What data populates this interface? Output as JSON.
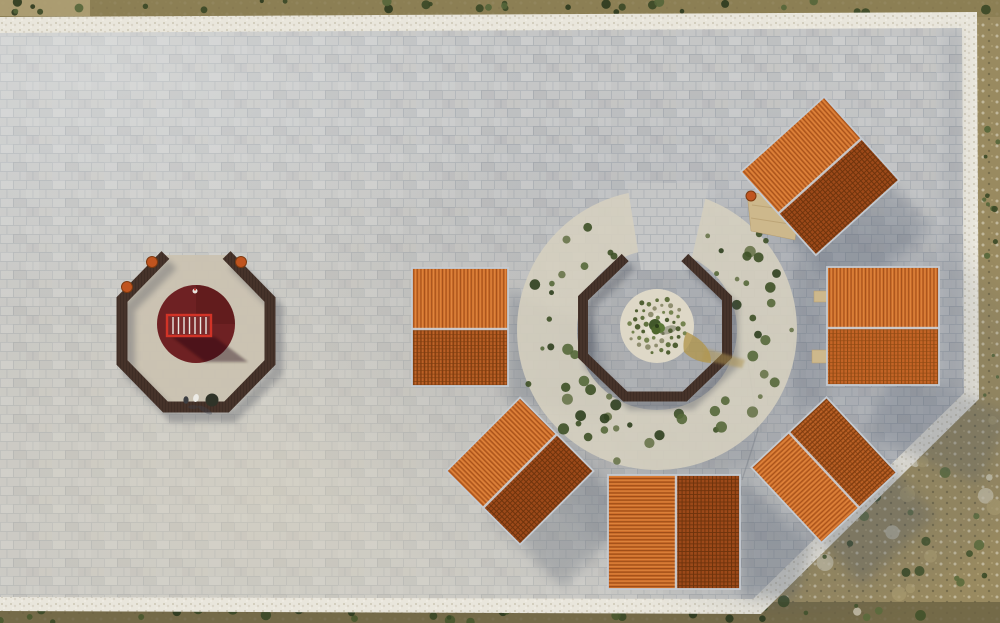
{
  "meta": {
    "title": "Aerial drone view of a stone-paved plaza with six orange-tiled pavilions around an octagonal planting circle and an octagonal play enclosure",
    "type": "aerial-photograph",
    "width": 1000,
    "height": 623
  },
  "palette": {
    "pavement": "#c3c4c5",
    "pavement_dark": "#aab0b6",
    "white_border": "#e9e6dc",
    "terrain": "#998a60",
    "terrain_top": "#8a7c52",
    "terrain_bottom": "#6d6444",
    "bush_green": "#3f5026",
    "roof_light": "#cf6f2c",
    "roof_dark": "#9c4919",
    "ridge_trim": "#cdd2d8",
    "bench_wood": "#46332a",
    "play_circle": "#6e2123",
    "railing_red": "#d23327",
    "gravel": "#d6d0bf",
    "gravel_light": "#ded8c7",
    "dirt": "#b2974f",
    "tree_green": "#4e662c",
    "barrel_orange": "#c0541f",
    "wood_platform": "#cdb88c",
    "shadow": "#4a5468"
  },
  "scene": {
    "plaza": {
      "shape": "irregular pentagon with beveled south-east corner",
      "paving": "light gray rectangular stone tiles",
      "border": "white crushed-stone band"
    },
    "pavilions": [
      {
        "id": "northeast",
        "transform": "translate(820,176) rotate(-42)",
        "size": "112x112",
        "ridge": "NE-SW",
        "lit_side": "NW"
      },
      {
        "id": "east",
        "transform": "translate(883,326)",
        "size": "112x119",
        "ridge": "E-W",
        "lit_side": "N"
      },
      {
        "id": "west",
        "transform": "translate(460,327)",
        "size": "96x119",
        "ridge": "E-W",
        "lit_side": "N"
      },
      {
        "id": "south",
        "transform": "translate(674,532)",
        "size": "132x115",
        "ridge": "N-S",
        "lit_side": "W"
      },
      {
        "id": "southwest",
        "transform": "translate(520,471) rotate(-45)",
        "size": "104x104",
        "ridge": "NE-SW",
        "lit_side": "NW"
      },
      {
        "id": "southeast",
        "transform": "translate(824,470) rotate(47)",
        "size": "103x103",
        "ridge": "NW-SE",
        "lit_side": "SW"
      }
    ],
    "left_octagon": {
      "center": [
        196,
        331
      ],
      "ring": "dark wood bench ring, open to north",
      "circle": "maroon rubber play surface with red railed platform",
      "barrels": 3,
      "people": 2
    },
    "right_octagon": {
      "center": [
        655,
        327
      ],
      "ring": "dark wood bench ring, open to north",
      "center_circle": "white gravel circle with spiral shrub planting and central tree",
      "surround": "crushed stone ring with shrubs"
    },
    "generators": {
      "ring_bushes": {
        "seed": 7,
        "count": 62,
        "cx": 657,
        "cy": 330,
        "r_min": 82,
        "r_max": 141,
        "angle_min": 28,
        "angle_max": 332,
        "r_dot": [
          2,
          6
        ],
        "colors": [
          "#3d5026",
          "#55683a",
          "#2e3f1e",
          "#68744a"
        ]
      },
      "spiral_plants": {
        "seed": 3,
        "count": 46,
        "cx": 657,
        "cy": 326,
        "r_max": 30,
        "r_dot": [
          1.5,
          2.9
        ],
        "colors": [
          "#5a6c38",
          "#48592b",
          "#6f7f4a",
          "#8a8a6a"
        ]
      },
      "terrain_bushes": [
        {
          "seed": 11,
          "rect": [
            0,
            0,
            1000,
            13
          ],
          "count": 32,
          "r": [
            2,
            5
          ],
          "colors": [
            "#3a4826",
            "#55663a",
            "#2c3a1e"
          ]
        },
        {
          "seed": 21,
          "rect": [
            978,
            16,
            22,
            384
          ],
          "count": 13,
          "r": [
            1.5,
            3.5
          ],
          "colors": [
            "#3a4826",
            "#55663a"
          ]
        },
        {
          "seed": 31,
          "rect": [
            778,
            405,
            222,
            215
          ],
          "count": 36,
          "r": [
            2,
            6
          ],
          "colors": [
            "#43522a",
            "#394823",
            "#5c6b3c"
          ]
        },
        {
          "seed": 41,
          "rect": [
            0,
            606,
            770,
            16
          ],
          "count": 34,
          "r": [
            2,
            5.5
          ],
          "colors": [
            "#2c3a1e",
            "#49582e",
            "#3a4826"
          ]
        }
      ],
      "rocks": {
        "seed": 51,
        "rect": [
          790,
          418,
          210,
          200
        ],
        "count": 22,
        "r": [
          3,
          9
        ],
        "colors": [
          "#d4cdba",
          "#c7bfa8",
          "#ab9b6d"
        ]
      }
    }
  }
}
